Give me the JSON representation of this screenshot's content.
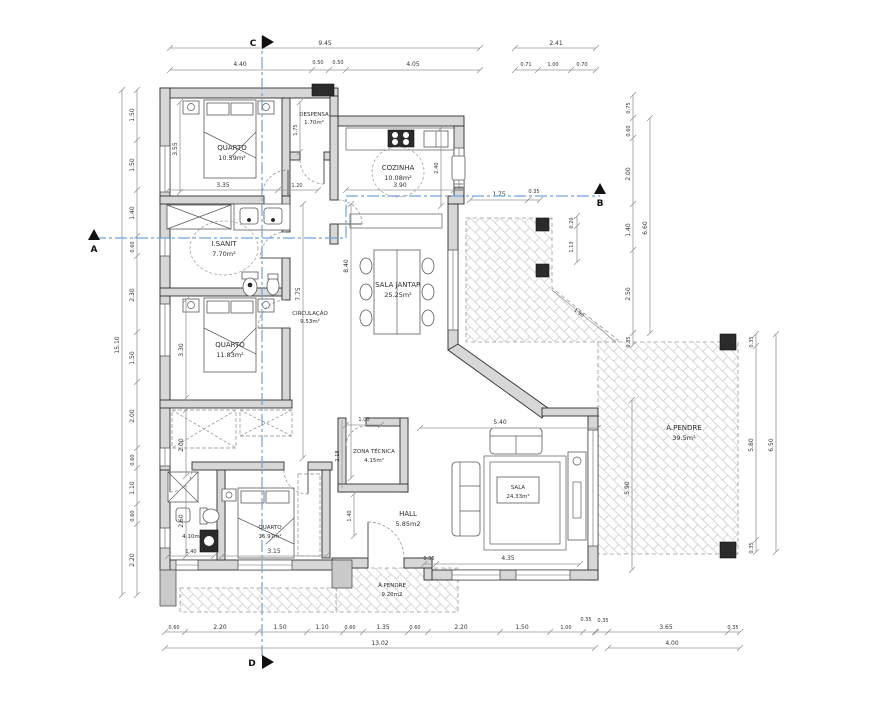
{
  "drawing": {
    "type": "architectural-floor-plan",
    "rooms": {
      "quarto1": {
        "name": "QUARTO",
        "area": "10.59m²"
      },
      "despensa": {
        "name": "DESPENSA",
        "area": "1.70m²"
      },
      "cozinha": {
        "name": "COZINHA",
        "area": "10.08m²"
      },
      "isanit1": {
        "name": "I.SANIT",
        "area": "7.70m²"
      },
      "circulacao": {
        "name": "CIRCULAÇÃO",
        "area": "9.53m²"
      },
      "quarto2": {
        "name": "QUARTO",
        "area": "11.83m²"
      },
      "sala_jantar": {
        "name": "SALA JANTAR",
        "area": "25.25m²"
      },
      "zona_tecnica": {
        "name": "ZONA TÉCNICA",
        "area": "4.15m²"
      },
      "quarto3": {
        "name": "QUARTO",
        "area": "16.97m²"
      },
      "isanit2": {
        "name": "I.SANIT",
        "area": "4.10m²"
      },
      "hall": {
        "name": "HALL",
        "area": "5.85m2"
      },
      "sala": {
        "name": "SALA",
        "area": "24.33m²"
      },
      "alpendre_entrada": {
        "name": "Á.PENDRE",
        "area": "9.20m2"
      },
      "alpendre_grande": {
        "name": "Á.PENDRE",
        "area": "39.5m²"
      }
    },
    "markers": {
      "a": "A",
      "b": "B",
      "c": "C",
      "d": "D"
    },
    "dims": {
      "top": [
        "9.45",
        "2.41",
        "4.40",
        "0.50",
        "0.50",
        "4.05",
        "0.71",
        "1.00",
        "0.70"
      ],
      "left": [
        "1.50",
        "1.50",
        "1.40",
        "0.60",
        "2.30",
        "1.50",
        "2.00",
        "0.60",
        "1.10",
        "0.60",
        "2.20",
        "15.10"
      ],
      "bottom": [
        "0.60",
        "2.20",
        "1.50",
        "1.10",
        "0.60",
        "1.35",
        "0.60",
        "2.20",
        "1.50",
        "1.00",
        "0.35",
        "13.02"
      ],
      "bottom_right": [
        "0.35",
        "3.65",
        "0.35",
        "4.00"
      ],
      "right": [
        "0.75",
        "0.60",
        "2.00",
        "1.40",
        "2.50",
        "0.35",
        "6.60",
        "1.75",
        "0.35",
        "0.20",
        "1.13"
      ],
      "far_right": [
        "0.35",
        "5.80",
        "0.35",
        "6.50",
        "5.90"
      ],
      "inner": [
        "3.55",
        "3.35",
        "1.20",
        "1.75",
        "3.90",
        "2.40",
        "8.40",
        "7.75",
        "3.30",
        "2.00",
        "2.60",
        "1.00",
        "2.18",
        "5.40",
        "1.40",
        "0.35",
        "4.35",
        "1.40",
        "3.15",
        "1.90"
      ]
    }
  }
}
